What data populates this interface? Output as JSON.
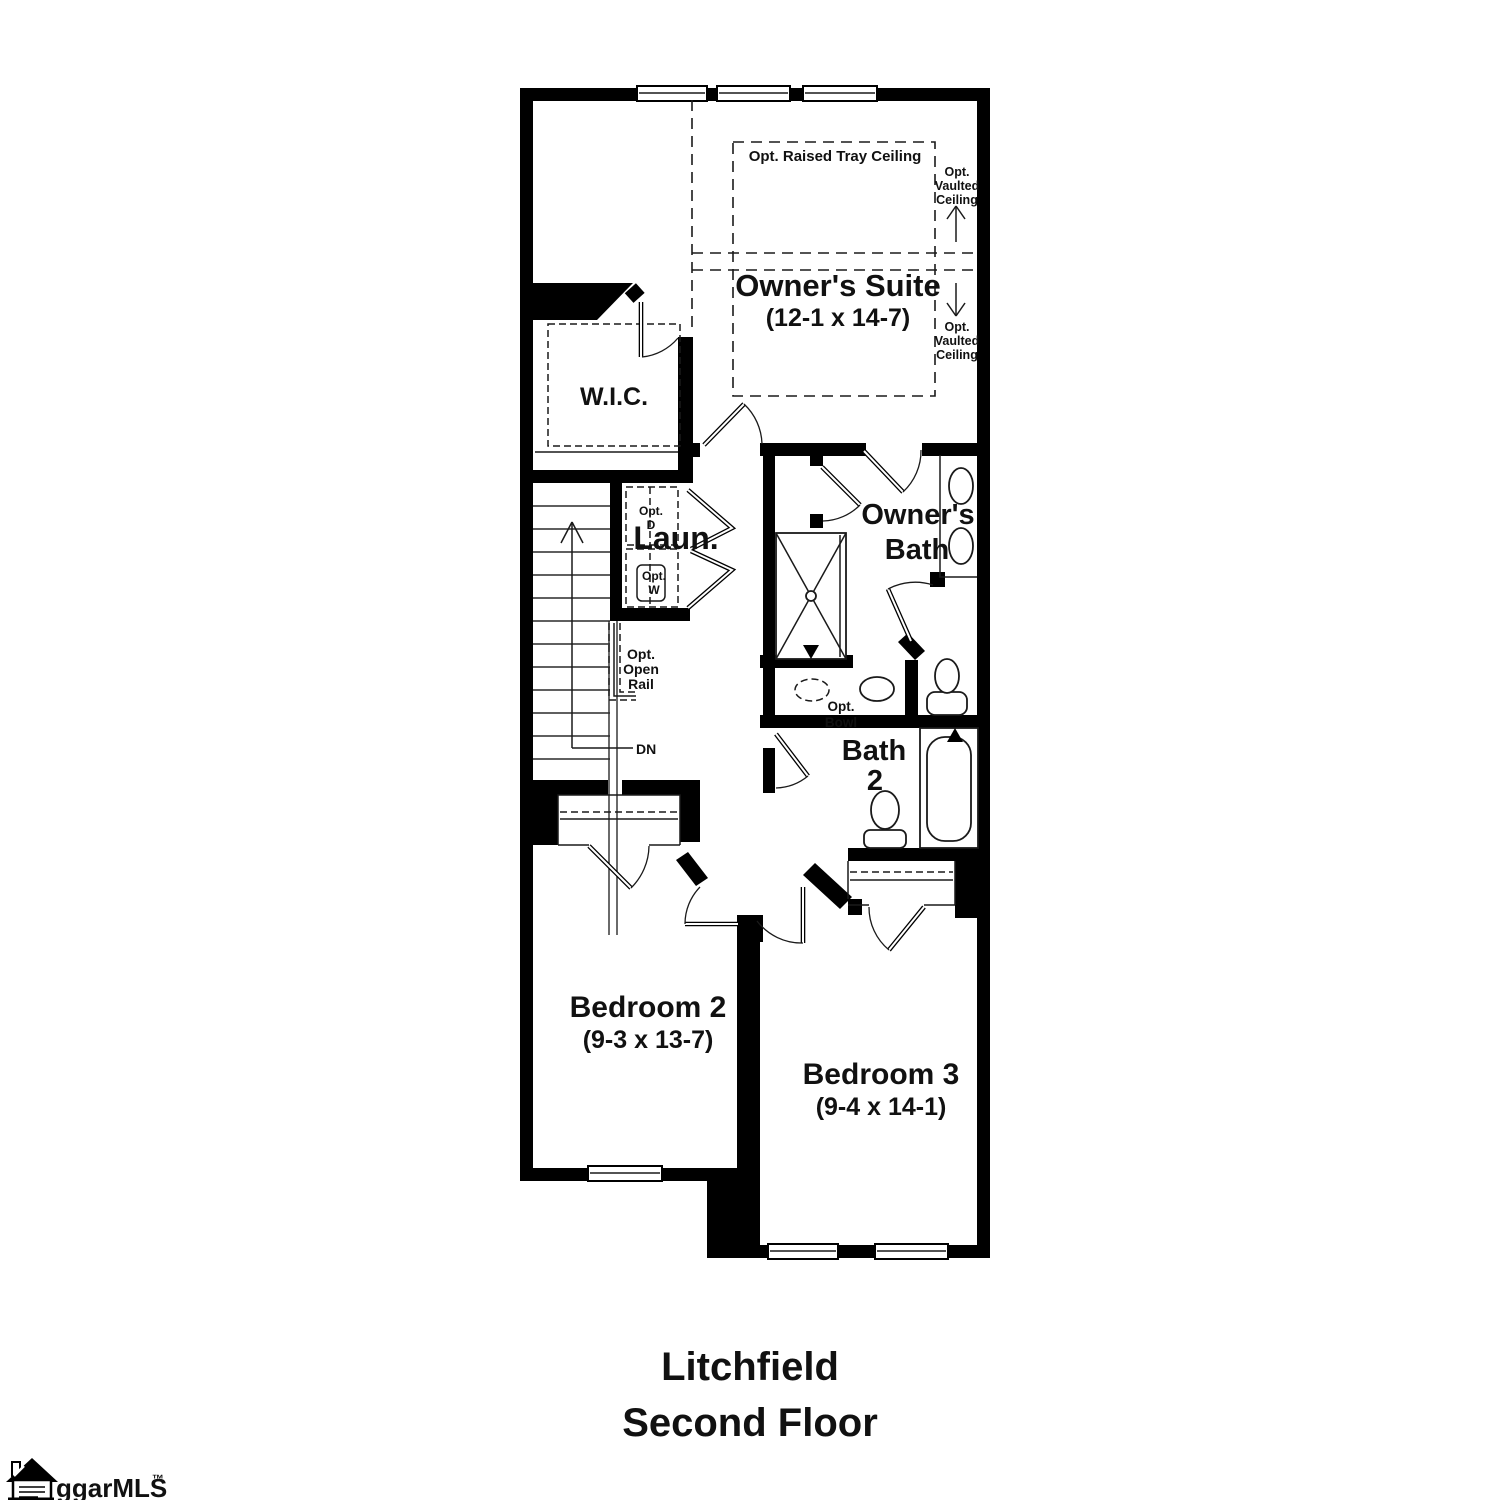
{
  "plan": {
    "owners_suite": {
      "name": "Owner's Suite",
      "dims": "(12-1 x 14-7)"
    },
    "wic": "W.I.C.",
    "laundry": "Laun.",
    "owners_bath": [
      "Owner's",
      "Bath"
    ],
    "bath2": [
      "Bath",
      "2"
    ],
    "bedroom2": {
      "name": "Bedroom 2",
      "dims": "(9-3 x 13-7)"
    },
    "bedroom3": {
      "name": "Bedroom 3",
      "dims": "(9-4 x 14-1)"
    },
    "tray_ceiling": "Opt. Raised Tray Ceiling",
    "vaulted_upper": [
      "Opt.",
      "Vaulted",
      "Ceiling"
    ],
    "vaulted_lower": [
      "Opt.",
      "Vaulted",
      "Ceiling"
    ],
    "opt_d": [
      "Opt.",
      "D"
    ],
    "opt_w": [
      "Opt.",
      "W"
    ],
    "open_rail": [
      "Opt.",
      "Open",
      "Rail"
    ],
    "opt_bowl": [
      "Opt.",
      "Bowl"
    ],
    "dn": "DN"
  },
  "title": [
    "Litchfield",
    "Second Floor"
  ],
  "logo": {
    "text": "ggarMLS",
    "tm": "™"
  },
  "colors": {
    "wall": "#000000",
    "background": "#ffffff",
    "text": "#111111"
  }
}
